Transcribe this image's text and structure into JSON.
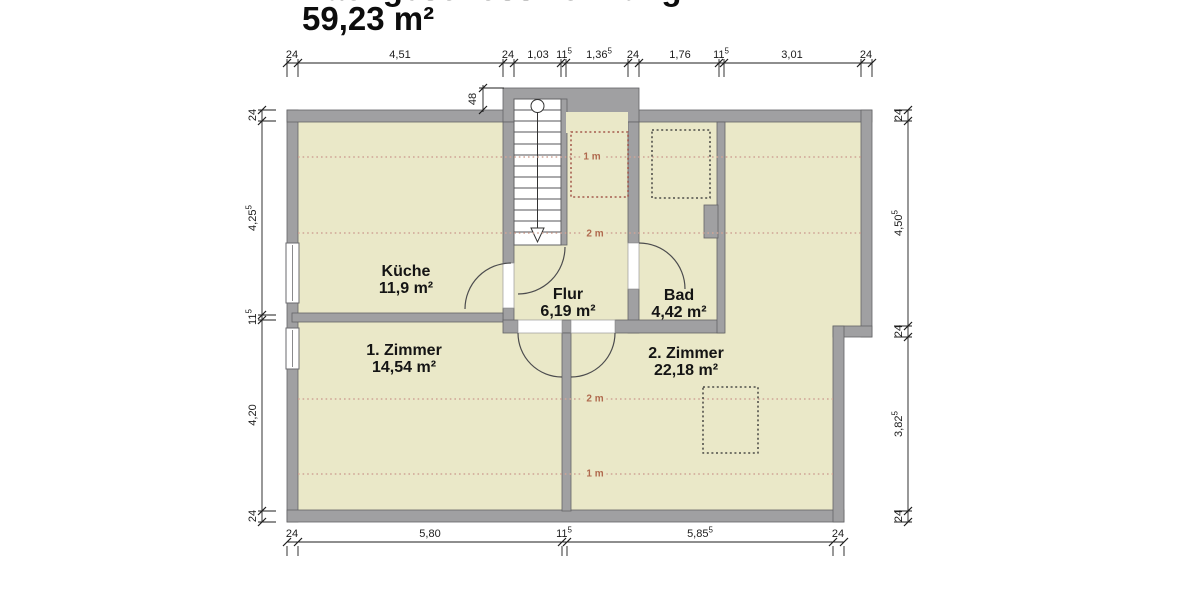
{
  "title": {
    "line1": "Dachgeschosswohnung",
    "line2": "59,23 m²"
  },
  "colors": {
    "background": "#ffffff",
    "wall_fill": "#a0a0a2",
    "wall_stroke": "#636366",
    "room_fill": "#eae8c8",
    "stair_line": "#55565a",
    "door_arc": "#4c4c4e",
    "dim_line": "#1c1c1c",
    "height_line": "#d0a496",
    "height_label": "#b06a4e",
    "dashed_red": "#973f36",
    "dashed_black": "#2e2e2e"
  },
  "rooms": [
    {
      "name": "kueche",
      "label": "Küche",
      "area": "11,9 m²",
      "cx": 406,
      "cy": 272
    },
    {
      "name": "flur",
      "label": "Flur",
      "area": "6,19 m²",
      "cx": 568,
      "cy": 295
    },
    {
      "name": "bad",
      "label": "Bad",
      "area": "4,42 m²",
      "cx": 679,
      "cy": 296
    },
    {
      "name": "zimmer1",
      "label": "1. Zimmer",
      "area": "14,54 m²",
      "cx": 404,
      "cy": 351
    },
    {
      "name": "zimmer2",
      "label": "2. Zimmer",
      "area": "22,18 m²",
      "cx": 686,
      "cy": 354
    }
  ],
  "height_labels": [
    {
      "text": "1 m",
      "x": 592,
      "y": 157
    },
    {
      "text": "2 m",
      "x": 595,
      "y": 234
    },
    {
      "text": "2 m",
      "x": 595,
      "y": 399
    },
    {
      "text": "1 m",
      "x": 595,
      "y": 474
    }
  ],
  "dims": {
    "top": {
      "y": 63,
      "x1": 287,
      "x2": 872,
      "stub": 14,
      "ticks": [
        287,
        298,
        503,
        514,
        561,
        566,
        628,
        639,
        719,
        724,
        861,
        872
      ],
      "labels": [
        {
          "t": "24",
          "x": 292
        },
        {
          "t": "4,51",
          "x": 400
        },
        {
          "t": "24",
          "x": 508
        },
        {
          "t": "1,03",
          "x": 538
        },
        {
          "t": "11",
          "s": "5",
          "x": 564
        },
        {
          "t": "1,36",
          "s": "5",
          "x": 599
        },
        {
          "t": "24",
          "x": 633
        },
        {
          "t": "1,76",
          "x": 680
        },
        {
          "t": "11",
          "s": "5",
          "x": 721
        },
        {
          "t": "3,01",
          "x": 792
        },
        {
          "t": "24",
          "x": 866
        }
      ]
    },
    "bottom": {
      "y": 542,
      "x1": 287,
      "x2": 844,
      "stub": -14,
      "ticks": [
        287,
        298,
        562,
        567,
        833,
        844
      ],
      "labels": [
        {
          "t": "24",
          "x": 292
        },
        {
          "t": "5,80",
          "x": 430
        },
        {
          "t": "11",
          "s": "5",
          "x": 564
        },
        {
          "t": "5,85",
          "s": "5",
          "x": 700
        },
        {
          "t": "24",
          "x": 838
        }
      ]
    },
    "left": {
      "x": 262,
      "y1": 110,
      "y2": 522,
      "stub": 14,
      "ticks": [
        110,
        121,
        315,
        320,
        511,
        522
      ],
      "labels": [
        {
          "t": "24",
          "y": 115
        },
        {
          "t": "4,25",
          "s": "5",
          "y": 218
        },
        {
          "t": "11",
          "s": "5",
          "y": 317
        },
        {
          "t": "4,20",
          "y": 415
        },
        {
          "t": "24",
          "y": 516
        }
      ]
    },
    "right": {
      "x": 908,
      "y1": 110,
      "y2": 522,
      "stub": -14,
      "ticks": [
        110,
        121,
        326,
        337,
        511,
        522
      ],
      "labels": [
        {
          "t": "24",
          "y": 115
        },
        {
          "t": "4,50",
          "s": "5",
          "y": 223
        },
        {
          "t": "24",
          "y": 331
        },
        {
          "t": "3,82",
          "s": "5",
          "y": 424
        },
        {
          "t": "24",
          "y": 516
        }
      ]
    },
    "stair": {
      "x": 483,
      "y1": 85,
      "y2": 112,
      "ticks": [
        88,
        110
      ],
      "label": {
        "t": "48",
        "x": 473,
        "y": 99
      }
    }
  },
  "geometry": {
    "floor_areas": [
      {
        "n": "floor-upper",
        "r": [
          298,
          121,
          563,
          212
        ]
      },
      {
        "n": "floor-lower",
        "r": [
          298,
          333,
          535,
          178
        ]
      }
    ],
    "walls": [
      {
        "n": "wall-outer-left",
        "r": [
          287,
          110,
          11,
          412
        ]
      },
      {
        "n": "wall-outer-top",
        "r": [
          287,
          110,
          585,
          12
        ]
      },
      {
        "n": "wall-outer-bottom",
        "r": [
          287,
          510,
          557,
          12
        ]
      },
      {
        "n": "wall-outer-right-upper",
        "r": [
          861,
          110,
          11,
          227
        ]
      },
      {
        "n": "wall-step",
        "r": [
          833,
          326,
          39,
          11
        ]
      },
      {
        "n": "wall-outer-right-lower",
        "r": [
          833,
          326,
          11,
          196
        ]
      },
      {
        "n": "wall-stair-bump",
        "r": [
          503,
          88,
          136,
          34
        ]
      },
      {
        "n": "wall-kueche-flur-upper",
        "r": [
          503,
          122,
          11,
          141
        ]
      },
      {
        "n": "wall-kueche-flur-lower",
        "r": [
          503,
          308,
          11,
          14
        ]
      },
      {
        "n": "wall-stair-niche",
        "r": [
          561,
          99,
          6,
          146
        ]
      },
      {
        "n": "wall-bad-left-upper",
        "r": [
          628,
          122,
          11,
          121
        ]
      },
      {
        "n": "wall-bad-left-lower",
        "r": [
          628,
          289,
          11,
          44
        ]
      },
      {
        "n": "wall-kueche-zimmer1",
        "r": [
          292,
          313,
          211,
          9
        ]
      },
      {
        "n": "wall-flur-bottom-left",
        "r": [
          503,
          320,
          15,
          13
        ]
      },
      {
        "n": "wall-flur-bottom-stub",
        "r": [
          562,
          320,
          9,
          13
        ]
      },
      {
        "n": "wall-flur-bottom-right",
        "r": [
          615,
          320,
          109,
          13
        ]
      },
      {
        "n": "wall-zimmer-divider",
        "r": [
          562,
          333,
          9,
          178
        ]
      },
      {
        "n": "wall-bad-right",
        "r": [
          717,
          122,
          8,
          211
        ]
      },
      {
        "n": "wall-chimney-pillar",
        "r": [
          704,
          205,
          14,
          33
        ]
      }
    ],
    "floor_overlays": [
      {
        "n": "floor-niche",
        "r": [
          566,
          112,
          62,
          21
        ]
      }
    ],
    "stair": {
      "shaft": [
        514,
        99,
        47,
        146
      ],
      "treads_y": [
        110,
        121,
        132,
        144,
        155,
        166,
        177,
        188,
        199,
        210,
        221,
        232
      ],
      "center_x": 537.5,
      "line_y1": 107,
      "line_y2": 234,
      "circle": {
        "cx": 537.5,
        "cy": 106,
        "r": 6.5
      },
      "arrow_points": "531,228 544,228 537.5,242"
    },
    "windows": [
      {
        "n": "window-kueche",
        "r": [
          286,
          243,
          13,
          60
        ]
      },
      {
        "n": "window-zimmer1",
        "r": [
          286,
          328,
          13,
          41
        ]
      }
    ],
    "door_openings": [
      {
        "n": "door-opening-kueche",
        "r": [
          503,
          263,
          11,
          45
        ]
      },
      {
        "n": "door-opening-bad",
        "r": [
          628,
          243,
          11,
          46
        ]
      },
      {
        "n": "door-opening-zimmer1",
        "r": [
          518,
          320,
          44,
          13
        ]
      },
      {
        "n": "door-opening-zimmer2",
        "r": [
          571,
          320,
          44,
          13
        ]
      }
    ],
    "door_arcs": [
      {
        "n": "door-arc-kueche",
        "d": "M465,309 A46,46 0 0 1 511,263"
      },
      {
        "n": "door-arc-entry",
        "d": "M565,247 A47,47 0 0 1 518,294"
      },
      {
        "n": "door-arc-zimmer1",
        "d": "M518,333 A44,44 0 0 0 562,377"
      },
      {
        "n": "door-arc-zimmer2",
        "d": "M615,333 A44,44 0 0 1 571,377"
      },
      {
        "n": "door-arc-bad",
        "d": "M639,243 A46,46 0 0 1 685,289"
      }
    ],
    "height_lines": [
      {
        "n": "height-line-1m-upper",
        "x1": 298,
        "x2": 861,
        "y": 157
      },
      {
        "n": "height-line-2m-upper",
        "x1": 298,
        "x2": 861,
        "y": 233
      },
      {
        "n": "height-line-2m-lower",
        "x1": 298,
        "x2": 833,
        "y": 399
      },
      {
        "n": "height-line-1m-lower",
        "x1": 298,
        "x2": 833,
        "y": 474
      }
    ],
    "dashed_rects": [
      {
        "n": "roof-window-niche",
        "r": [
          571,
          132,
          57,
          65
        ],
        "c": "red"
      },
      {
        "n": "roof-window-bad",
        "r": [
          652,
          130,
          58,
          68
        ],
        "c": "black"
      },
      {
        "n": "roof-window-zimmer2",
        "r": [
          703,
          387,
          55,
          66
        ],
        "c": "black"
      }
    ]
  }
}
